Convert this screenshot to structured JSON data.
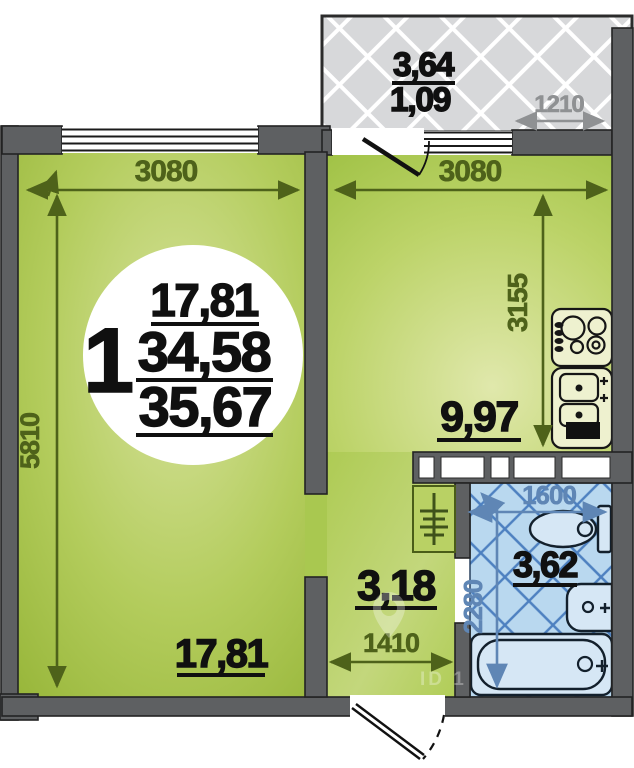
{
  "badge": {
    "rooms": "1",
    "values": [
      "17,81",
      "34,58",
      "35,67"
    ]
  },
  "living": {
    "area": "17,81",
    "dim_w": "3080",
    "dim_h": "5810"
  },
  "kitchen": {
    "area": "9,97",
    "dim_w": "3080",
    "dim_h": "3155"
  },
  "balcony": {
    "area_top": "3,64",
    "area_bottom": "1,09",
    "dim_w": "1210"
  },
  "hallway": {
    "area": "3,18",
    "dim_w": "1410"
  },
  "bathroom": {
    "area": "3,62",
    "dim_w": "1600",
    "dim_h": "2280"
  },
  "watermark": {
    "text": "ID 1"
  },
  "colors": {
    "wall": "#5e6062",
    "dim_olive": "#4e621a",
    "dim_gray": "#8f9193",
    "dim_blue": "#5f86b5",
    "label_black": "#101010",
    "bath_blue": "#b9d8ef",
    "bath_grid": "#4d80c0",
    "balcony_gray": "#d7d8da",
    "hall_green": "#b7d162",
    "living_green_edge": "#9aba3c",
    "living_green_center": "#d6e29b",
    "kitchen_green": "#b5d05e"
  }
}
